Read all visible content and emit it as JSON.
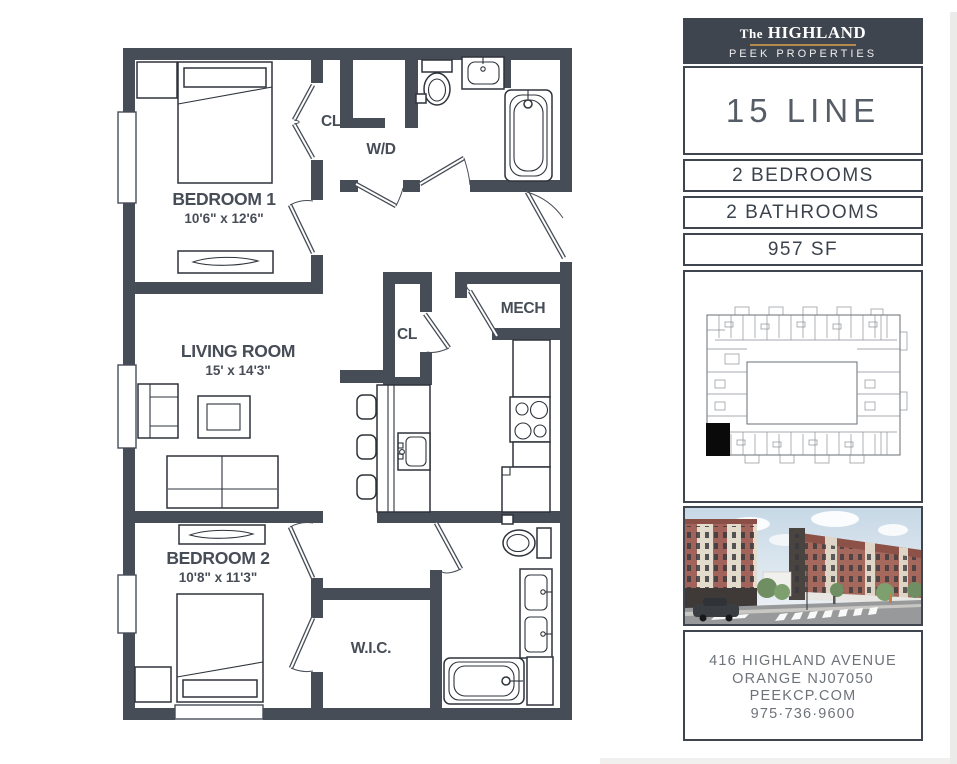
{
  "floor_plan": {
    "rooms": {
      "bedroom1": {
        "label": "BEDROOM 1",
        "dims": "10'6\" x 12'6\""
      },
      "bedroom2": {
        "label": "BEDROOM 2",
        "dims": "10'8\" x 11'3\""
      },
      "living": {
        "label": "LIVING ROOM",
        "dims": "15' x 14'3\""
      },
      "closet_top": {
        "label": "CL"
      },
      "closet_mid": {
        "label": "CL"
      },
      "laundry": {
        "label": "W/D"
      },
      "mech": {
        "label": "MECH"
      },
      "wic": {
        "label": "W.I.C."
      }
    }
  },
  "sidebar": {
    "brand": {
      "prefix": "The",
      "name": "HIGHLAND",
      "subtitle": "PEEK PROPERTIES"
    },
    "unit_name": "15 LINE",
    "specs": [
      {
        "label": "2 BEDROOMS"
      },
      {
        "label": "2 BATHROOMS"
      },
      {
        "label": "957 SF"
      }
    ],
    "address": [
      "416 HIGHLAND AVENUE",
      "ORANGE NJ07050",
      "PEEKCP.COM",
      "975·736·9600"
    ]
  },
  "colors": {
    "wall": "#474d57",
    "panel_border": "#3f454f",
    "accent_gold": "#b5894b",
    "unit_marker": "#0a0a0a"
  }
}
